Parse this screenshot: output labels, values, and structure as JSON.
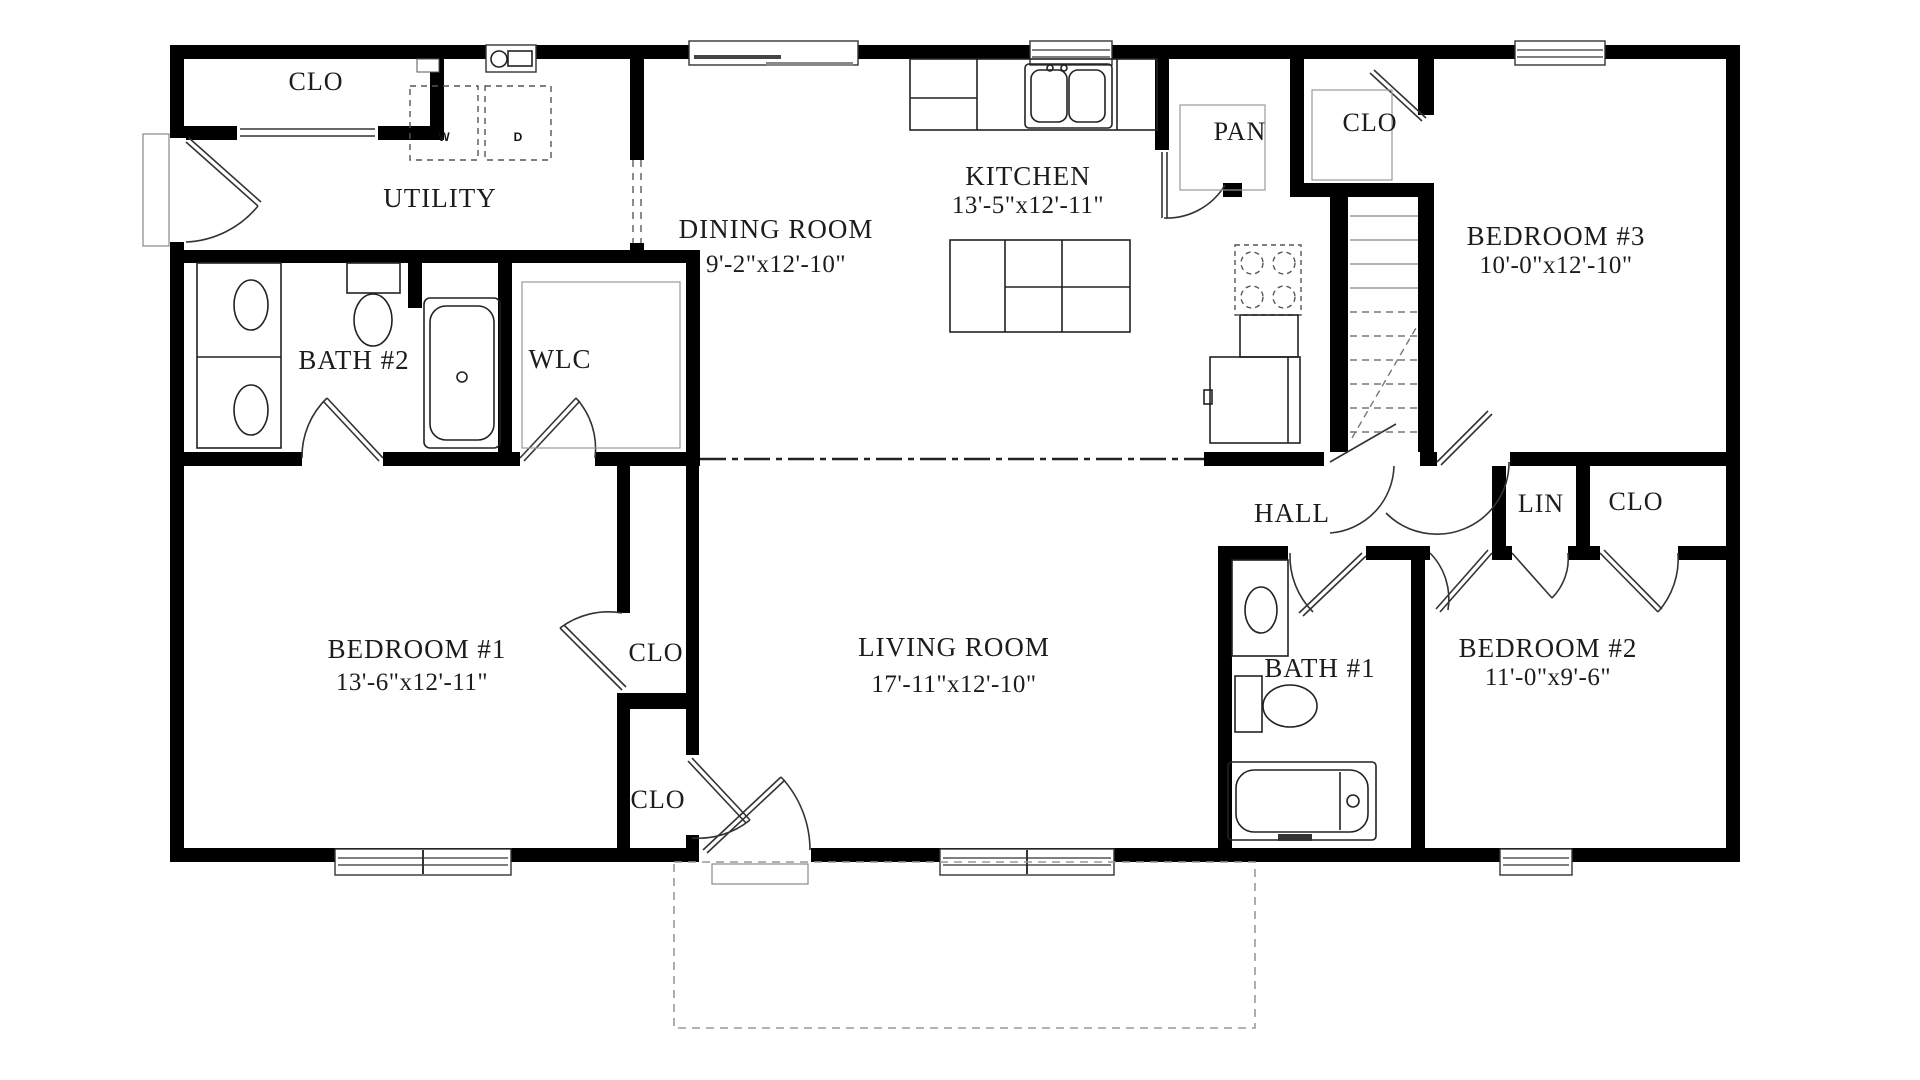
{
  "rooms": {
    "utility": {
      "label": "UTILITY"
    },
    "dining": {
      "label": "DINING ROOM",
      "dims": "9'-2\"x12'-10\""
    },
    "kitchen": {
      "label": "KITCHEN",
      "dims": "13'-5\"x12'-11\""
    },
    "pantry": {
      "label": "PAN"
    },
    "bedroom3": {
      "label": "BEDROOM #3",
      "dims": "10'-0\"x12'-10\""
    },
    "bath2": {
      "label": "BATH #2"
    },
    "wlc": {
      "label": "WLC"
    },
    "hall": {
      "label": "HALL"
    },
    "lin": {
      "label": "LIN"
    },
    "bedroom1": {
      "label": "BEDROOM #1",
      "dims": "13'-6\"x12'-11\""
    },
    "living": {
      "label": "LIVING ROOM",
      "dims": "17'-11\"x12'-10\""
    },
    "bath1": {
      "label": "BATH #1"
    },
    "bedroom2": {
      "label": "BEDROOM #2",
      "dims": "11'-0\"x9'-6\""
    }
  },
  "closets": {
    "utility_clo": "CLO",
    "bedroom3_clo": "CLO",
    "bedroom1_clo_upper": "CLO",
    "bedroom1_clo_lower": "CLO",
    "bedroom2_clo": "CLO"
  },
  "appliances": {
    "washer": "W",
    "dryer": "D"
  },
  "colors": {
    "wall": "#000000",
    "background": "#ffffff",
    "ink": "#1c1c1c"
  }
}
